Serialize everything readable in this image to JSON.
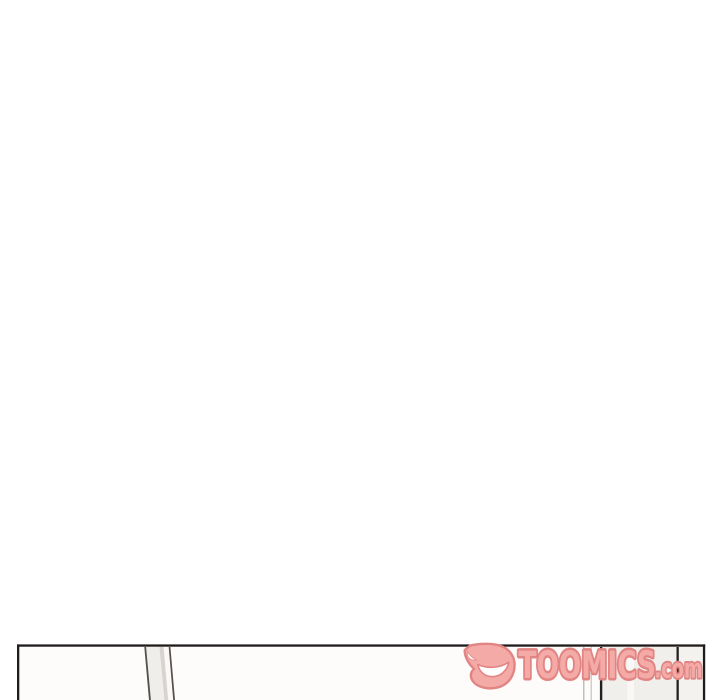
{
  "canvas": {
    "width": 720,
    "height": 700,
    "background_color": "#ffffff"
  },
  "panel": {
    "description": "top sliver of a webtoon comic panel entering from the bottom edge; interior mostly blank",
    "border_color": "#1e1c1b",
    "interior_color": "#fdfcfb"
  },
  "art": {
    "door": {
      "line_color": "#57514c",
      "band_color": "#f0eeea",
      "stripe_color": "#d7d3cf",
      "highlight_color": "#faf9f7"
    },
    "wall": {
      "thin_line_color_a": "#b4afaa",
      "thin_line_color_b": "#c8c3be",
      "dark_line_color": "#232120",
      "band_color": "#f1efec",
      "band_highlight_color": "#f9f8f6",
      "right_band_color": "#f4f2ef"
    }
  },
  "watermark": {
    "brand": "TOOMICS",
    "suffix": ".com",
    "fill_color": "#f4aba8",
    "outline_color": "#e28482",
    "grin_color": "#ffffff"
  }
}
